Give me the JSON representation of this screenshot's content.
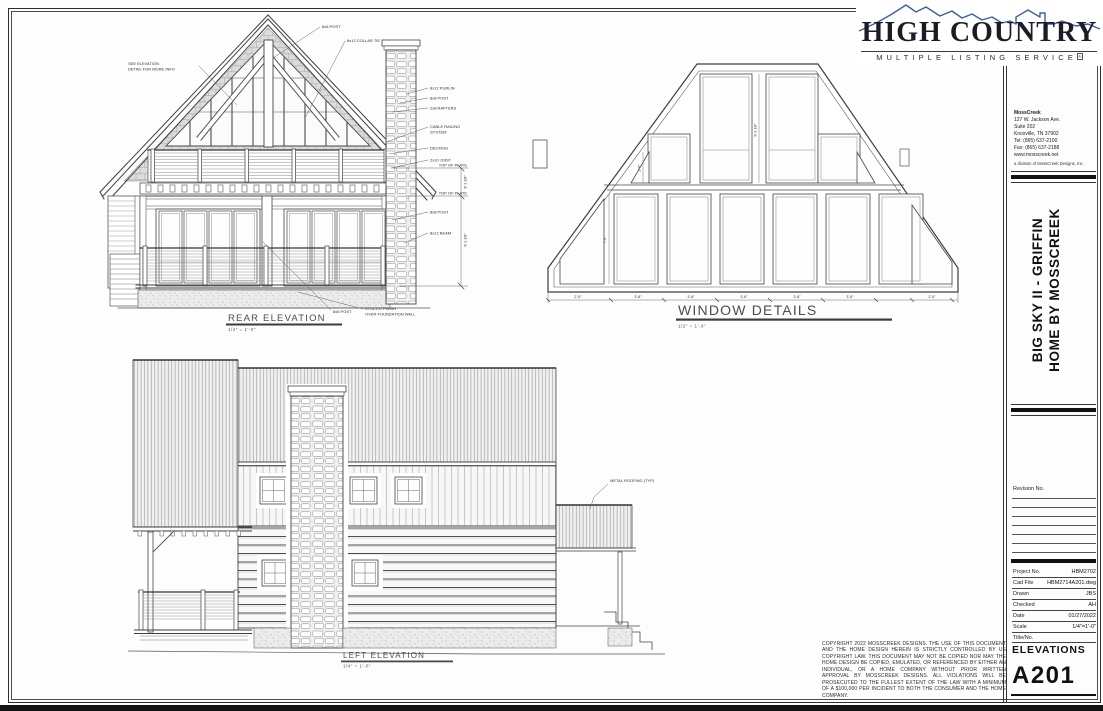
{
  "logo": {
    "title": "HIGH COUNTRY",
    "subtitle": "MULTIPLE LISTING SERVICE",
    "mark": "®",
    "mountain_color": "#3d5fa5",
    "text_color": "#1c1c26"
  },
  "titleblock": {
    "firm": {
      "name": "MossCreek",
      "address1": "127 W. Jackson Ave.",
      "address2": "Suite 202",
      "address3": "Knoxville, TN 37902",
      "tel": "Tel:  (865) 637-2100",
      "fax": "Fax: (865) 637-2188",
      "web": "www.mosscreek.net",
      "tagline": "a division of MossCreek Designs, Inc."
    },
    "project_title_line1": "BIG SKY II - GRIFFIN",
    "project_title_line2": "HOME BY MOSSCREEK",
    "revision_label": "Revision  No.",
    "fields": [
      {
        "label": "Project  No.",
        "value": "HBM2702"
      },
      {
        "label": "Cad  File",
        "value": "HBM2714A201.dwg"
      },
      {
        "label": "Drawn",
        "value": "JBS"
      },
      {
        "label": "Checked",
        "value": "AH"
      },
      {
        "label": "Date",
        "value": "01/27/2022"
      },
      {
        "label": "Scale",
        "value": "1/4\"=1'-0\""
      }
    ],
    "title_no_label": "Title/No.",
    "sheet_title": "ELEVATIONS",
    "sheet_number": "A201"
  },
  "drawings": {
    "rear": {
      "title": "REAR ELEVATION",
      "scale": "1/4\" = 1'-0\"",
      "callouts": [
        "8x8 POST",
        "8x12 COLLAR TIE",
        "SEE ELEVATION",
        "DETAIL FOR MORE INFO",
        "8x12 PURLIN",
        "8x8 POST",
        "2x8 RAFTERS",
        "CABLE RAILING",
        "SYSTEM",
        "DECKING",
        "2x10 JOIST",
        "TOP OF PLATE",
        "TOP OF PLATE",
        "8x8 POST",
        "8x12 BEAM",
        "8x8 POST",
        "STUCCO FINISH",
        "OVER FOUNDATION WALL"
      ],
      "dims": [
        "9'-1 1/8\"",
        "9'-1 1/8\""
      ]
    },
    "window_details": {
      "title": "WINDOW DETAILS",
      "scale": "1/2\" = 1'-0\"",
      "dims_h": [
        "2'-5\"",
        "3'-8\"",
        "3'-8\"",
        "3'-8\"",
        "3'-8\"",
        "3'-8\"",
        "2'-5\""
      ],
      "dims_v": [
        "7'-6\"",
        "2'-8\"",
        "9'-1 1/8\""
      ]
    },
    "left": {
      "title": "LEFT ELEVATION",
      "scale": "1/4\" = 1'-0\"",
      "callouts": [
        "METAL ROOFING (TYP)"
      ]
    }
  },
  "copyright": "Copyright 2022 MossCreek Designs. The use of this document and the home design herein is strictly controlled by US Copyright law. This document may not be copied nor may the home design be copied, emulated, or referenced by either an individual, or a home company without prior written approval by MossCreek Designs. All violations will be prosecuted to the fullest extent of the law with a minimum of a $100,000 per incident to both the consumer and the home company."
}
